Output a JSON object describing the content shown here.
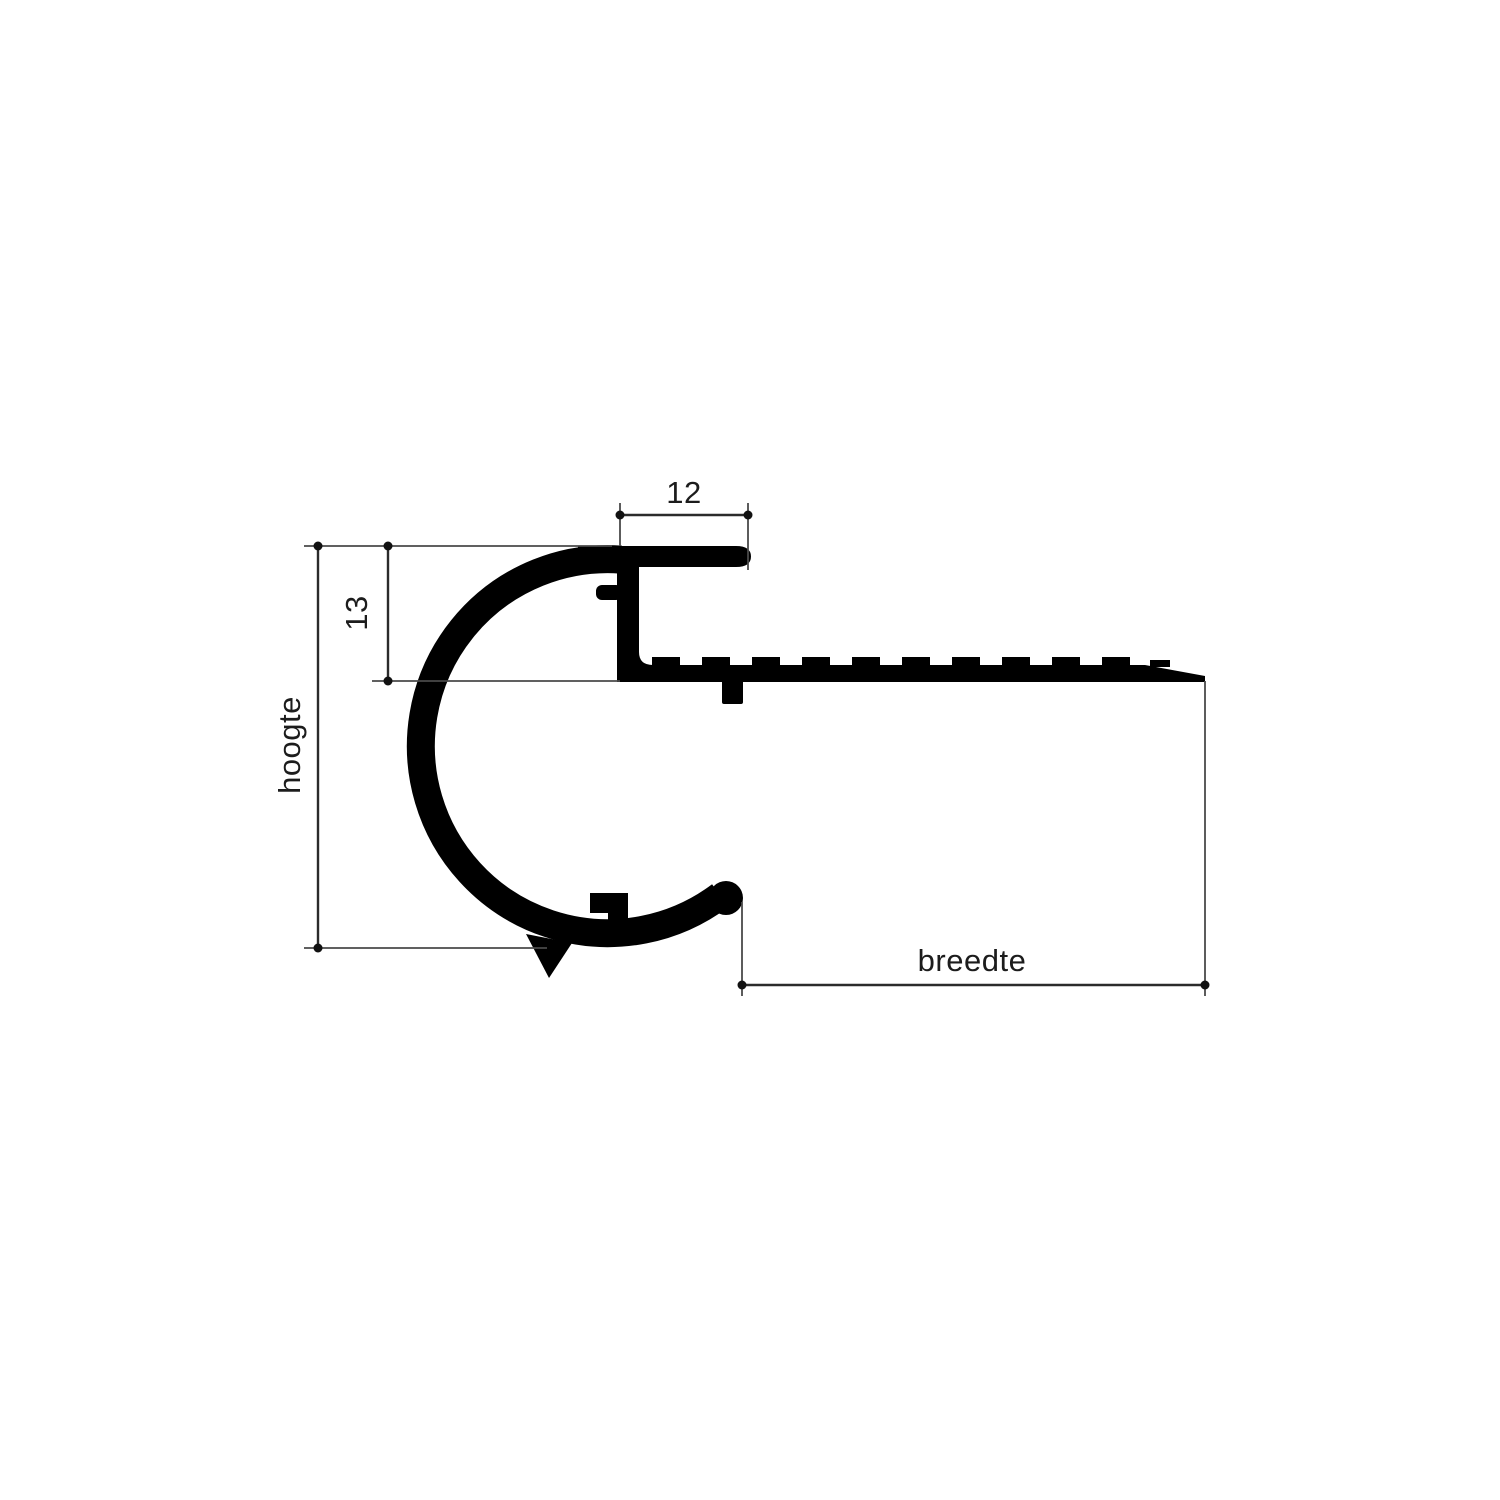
{
  "diagram": {
    "type": "technical-profile-cross-section",
    "dimensions": {
      "top_width": {
        "value": "12"
      },
      "upper_height": {
        "value": "13"
      },
      "height": {
        "label": "hoogte"
      },
      "width": {
        "label": "breedte"
      }
    },
    "colors": {
      "profile": "#000000",
      "dimension_lines": "#2b2b2b",
      "extension_lines": "#4a4a4a",
      "text": "#1c1c1c",
      "background": "#ffffff"
    }
  }
}
